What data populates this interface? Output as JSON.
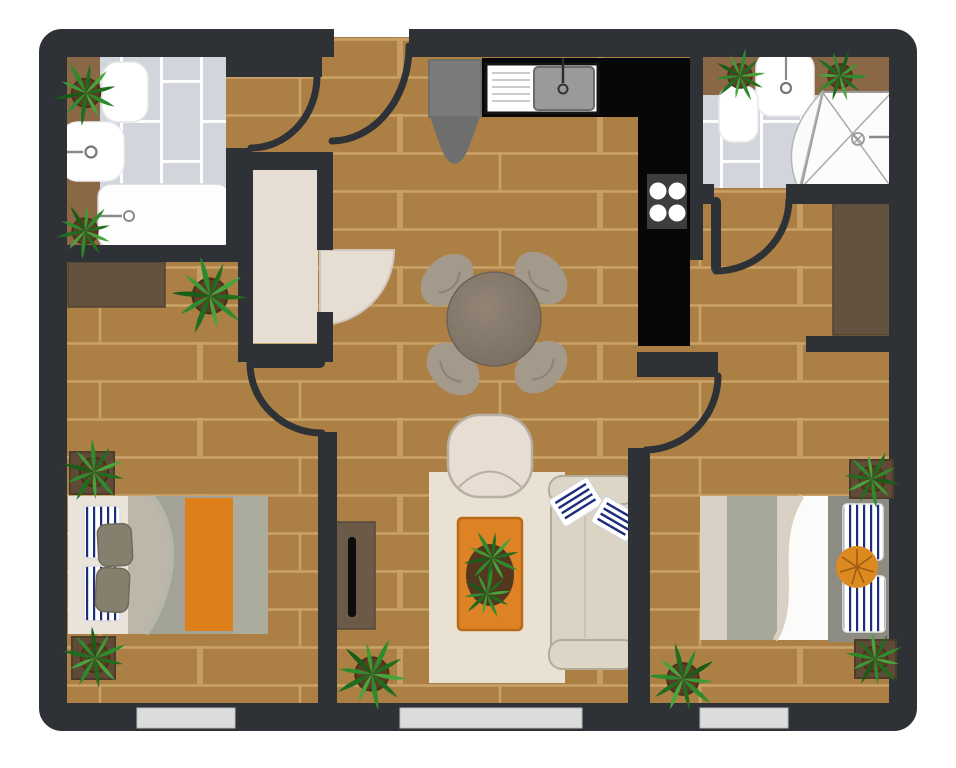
{
  "meta": {
    "title": "Apartment floor plan — top-down illustration",
    "type": "floor-plan",
    "canvas": {
      "width": 956,
      "height": 768
    }
  },
  "palette": {
    "wall": "#2e3236",
    "floor_brick": "#ac8044",
    "floor_mortar": "#c9a26a",
    "bathroom_tile": "#d2d6dc",
    "tile_grout": "#ffffff",
    "entry_floor": "#e6ddd3",
    "kitchen_counter": "#070707",
    "appliance_gray": "#7b7b7b",
    "wood_dark": "#63523f",
    "bathroom_shelf": "#8a6845",
    "rug": "#e9e2d3",
    "accent_orange": "#dd7f1b",
    "stripe_navy": "#1c2d7d",
    "plant_green": "#2e8b2d",
    "plant_green_dark": "#206d1f",
    "pot_brown": "#5b3d26",
    "window_glass": "#dcdcdc"
  },
  "rooms": [
    {
      "id": "bathroom-1",
      "label": "Bathroom (top left)",
      "floor": "gray vertical tile",
      "fixtures": [
        "bathtub with faucet",
        "wash basin with faucet",
        "toilet",
        "wooden shelf strip",
        "2 potted plants"
      ]
    },
    {
      "id": "entry-hall",
      "label": "Entry hall & vestibule",
      "floor": "brick + beige entry mat",
      "fixtures": [
        "front door arc",
        "entry door leaf (quarter circle)",
        "potted plant"
      ]
    },
    {
      "id": "kitchen",
      "label": "Kitchen (top center)",
      "floor": "brick",
      "fixtures": [
        "L-shaped black counter",
        "sink with drainboard and faucet",
        "4-burner stove",
        "refrigerator"
      ]
    },
    {
      "id": "bathroom-2",
      "label": "Bathroom (top right)",
      "floor": "gray tile",
      "fixtures": [
        "corner shower with curtain and drain",
        "wash basin with faucet",
        "toilet",
        "wooden shelf strip",
        "2 potted plants"
      ]
    },
    {
      "id": "living-dining",
      "label": "Living / dining room (center)",
      "floor": "brick",
      "fixtures": [
        "round dining table",
        "4 dining chairs",
        "cream rug",
        "orange coffee table with plant",
        "armchair",
        "sofa with 2 striped pillows",
        "TV console",
        "potted plant"
      ]
    },
    {
      "id": "bedroom-1",
      "label": "Bedroom (bottom left)",
      "floor": "brick",
      "fixtures": [
        "double bed with striped pillows, gray duvet and orange runner",
        "desk / dresser",
        "2 square planters"
      ]
    },
    {
      "id": "bedroom-2",
      "label": "Bedroom (bottom right)",
      "floor": "brick",
      "fixtures": [
        "double bed with striped pillows, white throw and orange round cushion",
        "wardrobe",
        "2 square planters",
        "potted plant"
      ]
    }
  ],
  "doors": [
    {
      "id": "front-door",
      "between": "outside / entry hall",
      "style": "arc"
    },
    {
      "id": "bathroom-1-door",
      "between": "entry hall / bathroom 1",
      "style": "arc"
    },
    {
      "id": "bedroom-1-door",
      "between": "bedroom 1 / living room",
      "style": "leaf + arc"
    },
    {
      "id": "entry-vestibule-door",
      "between": "vestibule / living room",
      "style": "filled quarter-circle leaf"
    },
    {
      "id": "bedroom-2-door",
      "between": "living room / bedroom 2",
      "style": "arc"
    },
    {
      "id": "bathroom-2-door",
      "between": "bathroom 2 / bedroom 2",
      "style": "leaf + arc"
    }
  ],
  "windows": [
    {
      "id": "window-bedroom-1",
      "wall": "bottom"
    },
    {
      "id": "window-living",
      "wall": "bottom"
    },
    {
      "id": "window-bedroom-2",
      "wall": "bottom"
    }
  ],
  "plants": {
    "total": 11,
    "round_pots": 7,
    "square_planters": 4
  }
}
